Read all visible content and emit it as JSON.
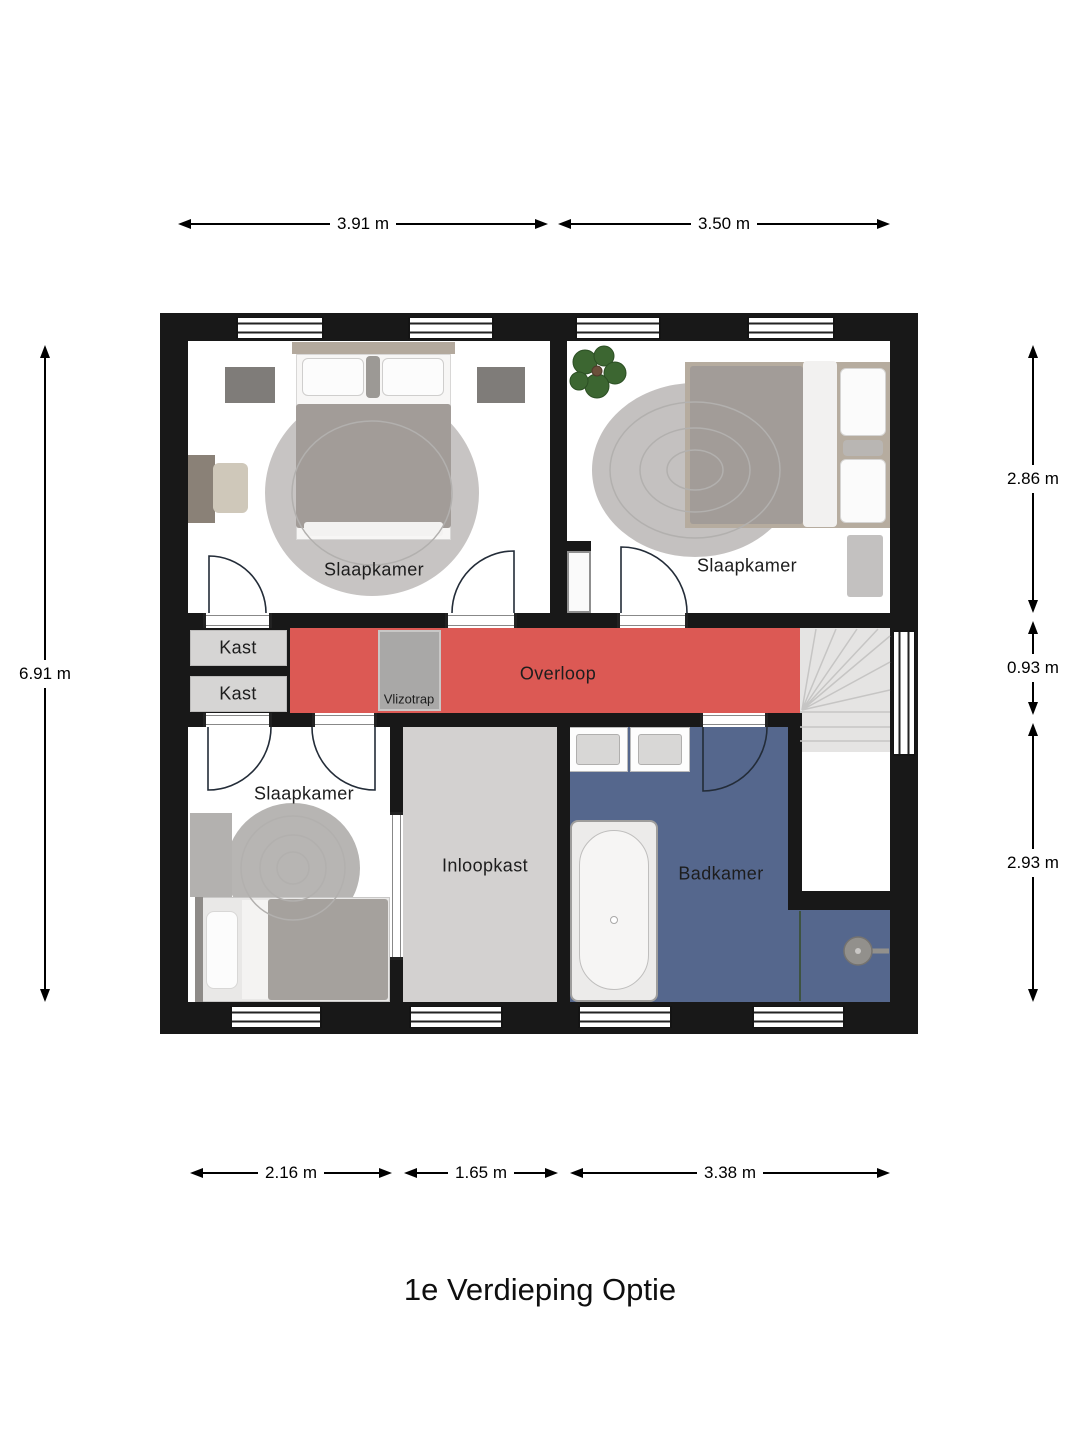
{
  "title": "1e Verdieping Optie",
  "floor_plan": {
    "rooms": {
      "bedroom_top_left": {
        "label": "Slaapkamer"
      },
      "bedroom_top_right": {
        "label": "Slaapkamer"
      },
      "bedroom_bottom_left": {
        "label": "Slaapkamer"
      },
      "closet_top": {
        "label": "Kast"
      },
      "closet_bottom": {
        "label": "Kast"
      },
      "landing": {
        "label": "Overloop"
      },
      "loft_ladder": {
        "label": "Vlizotrap"
      },
      "walk_in_closet": {
        "label": "Inloopkast"
      },
      "bathroom": {
        "label": "Badkamer"
      }
    },
    "dimensions": {
      "top": [
        {
          "label": "3.91 m"
        },
        {
          "label": "3.50 m"
        }
      ],
      "left": [
        {
          "label": "6.91 m"
        }
      ],
      "right": [
        {
          "label": "2.86 m"
        },
        {
          "label": "0.93 m"
        },
        {
          "label": "2.93 m"
        }
      ],
      "bottom": [
        {
          "label": "2.16 m"
        },
        {
          "label": "1.65 m"
        },
        {
          "label": "3.38 m"
        }
      ]
    },
    "colors": {
      "wall": "#181818",
      "landing_floor": "#dc5954",
      "bathroom_floor": "#55678d",
      "closet_floor": "#d6d5d4",
      "walk_in_closet_floor": "#d3d1d0",
      "stairs_floor": "#e5e4e3",
      "bedroom_floor": "#ffffff"
    }
  }
}
